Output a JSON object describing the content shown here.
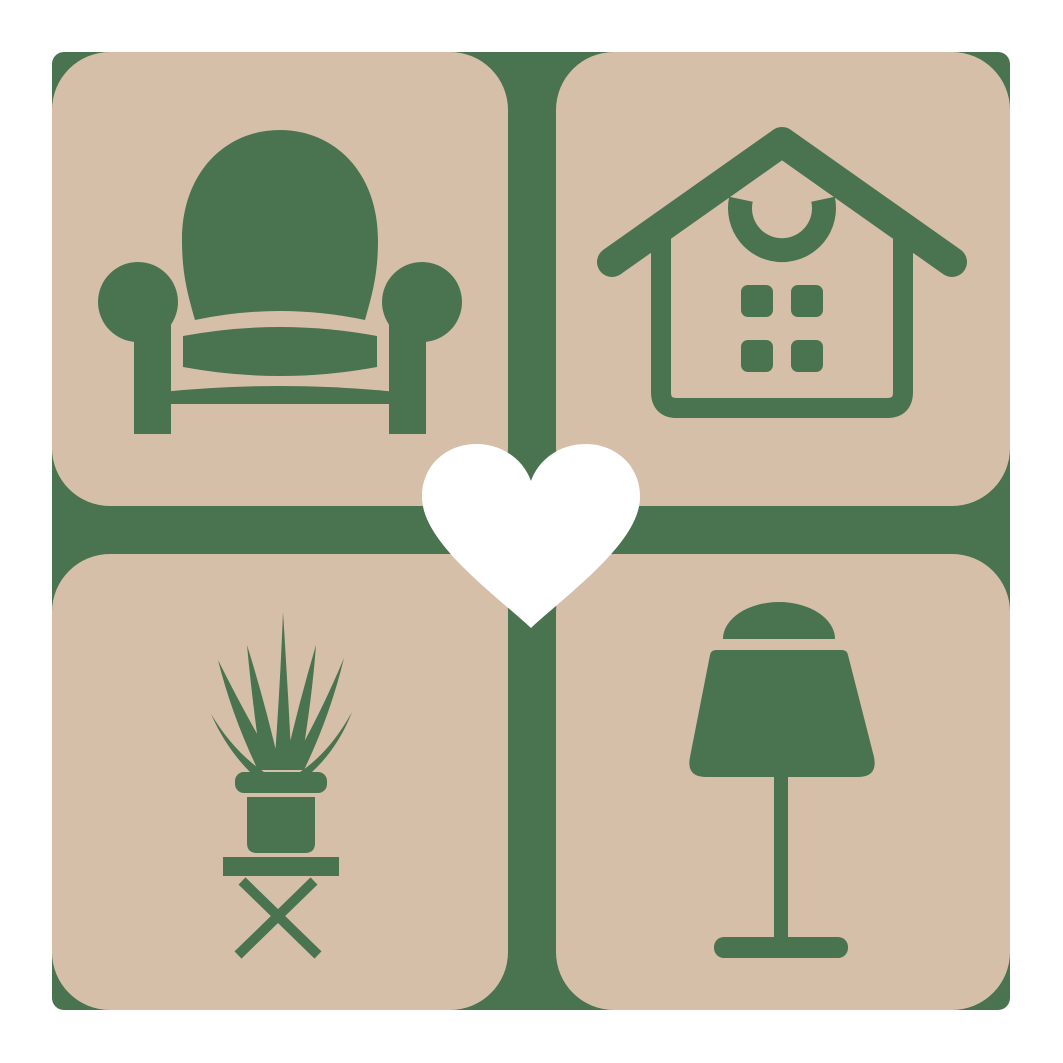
{
  "logo": {
    "description": "Home decor logo: 2x2 grid of rounded tan tiles with green furniture icons on a green backdrop cross, white heart at center",
    "colors": {
      "green": "#4a7350",
      "tan": "#d6bfa8",
      "heart": "#ffffff",
      "page_background": "#ffffff"
    },
    "tiles": [
      {
        "position": "top-left",
        "icon": "armchair"
      },
      {
        "position": "top-right",
        "icon": "house"
      },
      {
        "position": "bottom-left",
        "icon": "potted-plant"
      },
      {
        "position": "bottom-right",
        "icon": "table-lamp"
      }
    ],
    "center_icon": "heart"
  }
}
